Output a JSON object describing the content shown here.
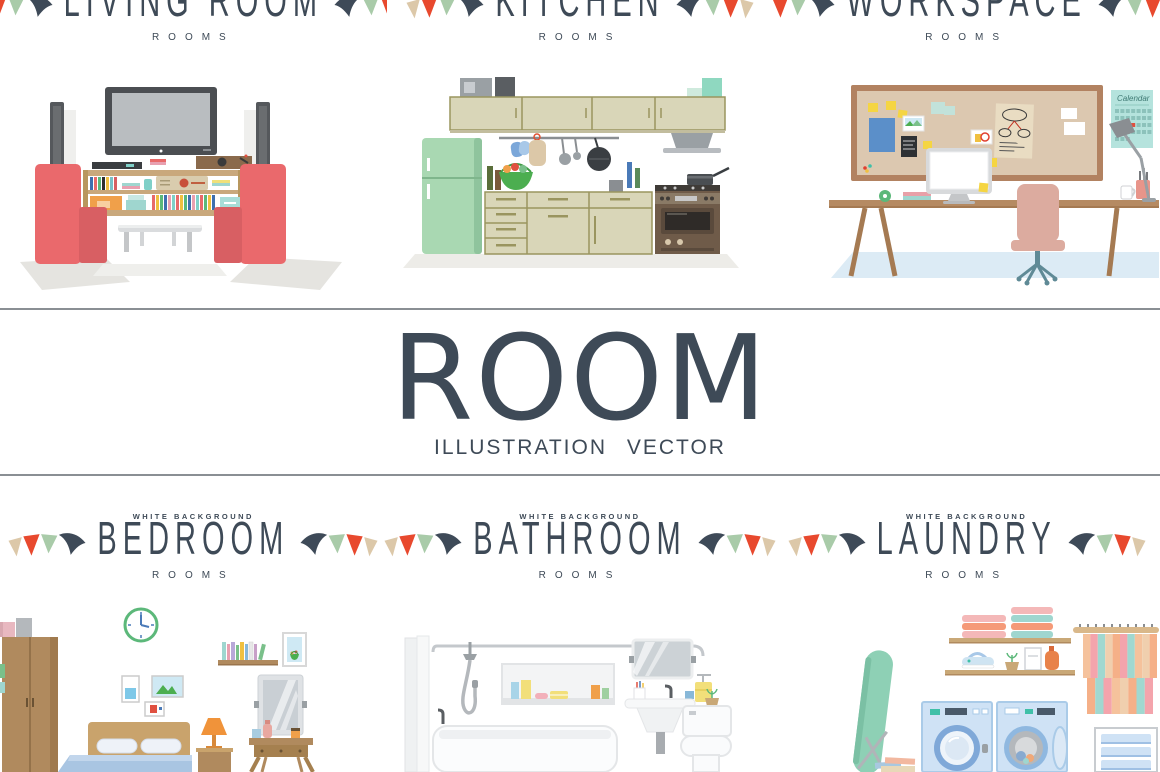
{
  "hero": {
    "title": "ROOM",
    "subtitle": "ILLUSTRATION VECTOR"
  },
  "top_row": [
    {
      "id": "living-room",
      "title": "LIVING ROOM",
      "subtitle": "ROOMS"
    },
    {
      "id": "kitchen",
      "title": "KITCHEN",
      "subtitle": "ROOMS"
    },
    {
      "id": "workspace",
      "title": "WORKSPACE",
      "subtitle": "ROOMS"
    }
  ],
  "bottom_row": [
    {
      "id": "bedroom",
      "overline": "WHITE BACKGROUND",
      "title": "BEDROOM",
      "subtitle": "ROOMS"
    },
    {
      "id": "bathroom",
      "overline": "WHITE BACKGROUND",
      "title": "BATHROOM",
      "subtitle": "ROOMS"
    },
    {
      "id": "laundry",
      "overline": "WHITE BACKGROUND",
      "title": "LAUNDRY",
      "subtitle": "ROOMS"
    }
  ],
  "illustrations": {
    "workspace_calendar_label": "Calendar"
  },
  "palette": {
    "text": "#3e4a57",
    "divider": "#8a8f94",
    "flag_navy": "#3e4a58",
    "flag_green": "#a9cba9",
    "flag_red": "#e8492e",
    "flag_beige": "#dcc8a9",
    "armchair_coral": "#ea696c",
    "fridge_mint": "#a9d8b2",
    "cabinet_beige": "#d9d6b8",
    "stove_brown": "#6f5b49",
    "wood": "#b08a5e",
    "cork_board": "#dcc8b0",
    "calendar_teal": "#b5e3dd",
    "floor_blue": "#dcebf5",
    "bed_blue": "#a9c5e2",
    "machine_blue": "#cfe2f5",
    "ironing_mint": "#8ed0b5",
    "desk_chair_pink": "#dcab9f"
  }
}
